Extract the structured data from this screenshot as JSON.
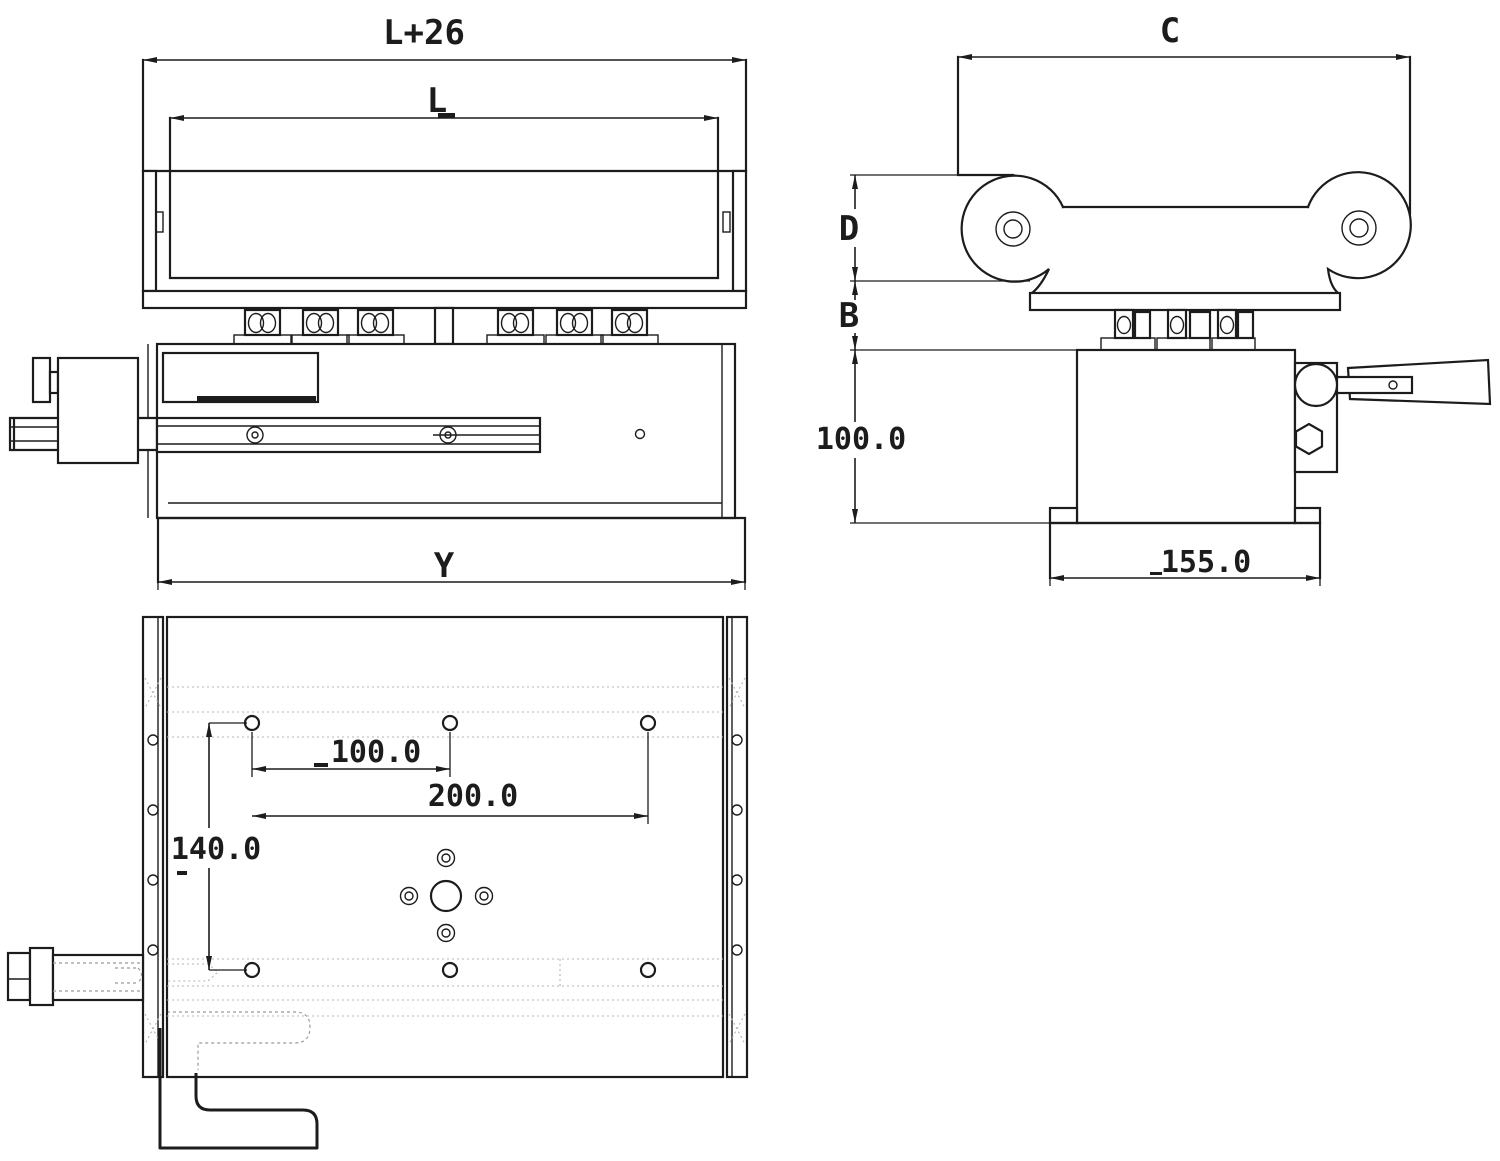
{
  "drawing": {
    "kind": "engineering-orthographic-views",
    "colors": {
      "line": "#1c1c1c",
      "hidden_line": "#9b9b9b",
      "background": "#ffffff"
    }
  },
  "front_view": {
    "dim_overall_width": "L+26",
    "dim_table_length": "L",
    "dim_base_width": "Y"
  },
  "side_view": {
    "dim_top_width": "C",
    "dim_bracket_height": "D",
    "dim_spacer_height": "B",
    "dim_body_height": "100.0",
    "dim_base_width": "155.0"
  },
  "bottom_view": {
    "dim_hole_pitch_small": "100.0",
    "dim_hole_pitch_large": "200.0",
    "dim_row_pitch": "140.0"
  }
}
